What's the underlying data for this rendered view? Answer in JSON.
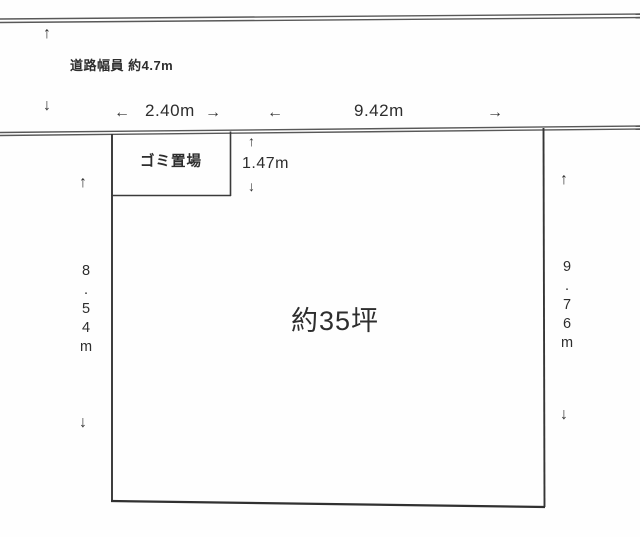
{
  "diagram": {
    "road": {
      "width_label": "道路幅員 約4.7m"
    },
    "garbage_area": {
      "label": "ゴミ置場",
      "width": "2.40m",
      "depth": "1.47m"
    },
    "plot": {
      "area_label": "約35坪",
      "frontage": "9.42m",
      "left_side": "8.54m",
      "right_side": "9.76m"
    }
  },
  "icons": {
    "arrow_up": "↑",
    "arrow_down": "↓",
    "arrow_left": "←",
    "arrow_right": "→"
  },
  "colors": {
    "line": "#353535",
    "road_line": "#585858",
    "text": "#2d2d2d",
    "background": "#ffffff"
  }
}
